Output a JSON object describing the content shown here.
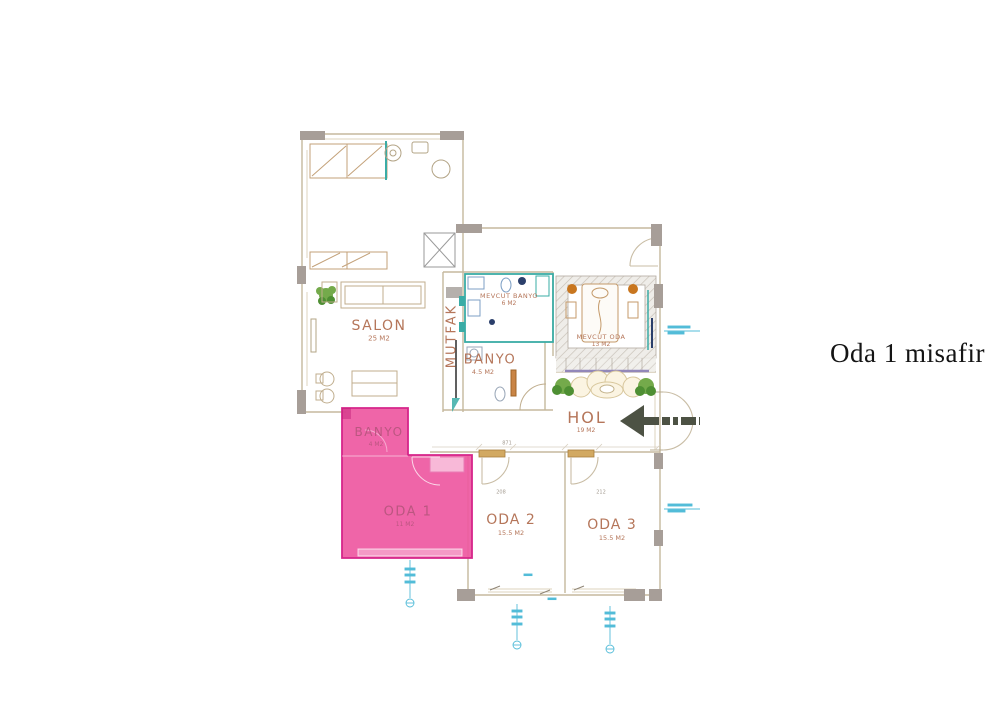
{
  "caption": {
    "text": "Oda 1 misafir"
  },
  "plan": {
    "title": "apartment floor plan",
    "rooms": [
      {
        "id": "salon",
        "name": "SALON",
        "area": "25 M2",
        "highlighted": false
      },
      {
        "id": "mutfak",
        "name": "MUTFAK",
        "area": "",
        "highlighted": false
      },
      {
        "id": "banyo",
        "name": "BANYO",
        "area": "4.5 M2",
        "highlighted": false
      },
      {
        "id": "mevcut-banyo",
        "name": "MEVCUT BANYO",
        "area": "6 M2",
        "highlighted": false
      },
      {
        "id": "mevcut-oda",
        "name": "MEVCUT ODA",
        "area": "13 M2",
        "highlighted": false
      },
      {
        "id": "hol",
        "name": "HOL",
        "area": "19 M2",
        "highlighted": false
      },
      {
        "id": "banyo-yeni",
        "name": "BANYO",
        "area": "4 M2",
        "highlighted": true
      },
      {
        "id": "oda-1",
        "name": "ODA 1",
        "area": "11 M2",
        "highlighted": true
      },
      {
        "id": "oda-2",
        "name": "ODA 2",
        "area": "15.5 M2",
        "highlighted": false
      },
      {
        "id": "oda-3",
        "name": "ODA 3",
        "area": "15.5 M2",
        "highlighted": false
      }
    ],
    "dimensions": [
      "871",
      "208",
      "212"
    ],
    "colors": {
      "highlight_fill": "#ee58a1",
      "highlight_border": "#d6258a",
      "room_label": "#b5765a",
      "wall": "#c5b89d",
      "column": "#a79e98",
      "teal": "#3aaca6",
      "cyan": "#53bcd8",
      "arrow": "#4d5244",
      "plant": "#74aa4b"
    },
    "annotation_arrow": {
      "direction": "left",
      "points_at": "HOL"
    }
  }
}
